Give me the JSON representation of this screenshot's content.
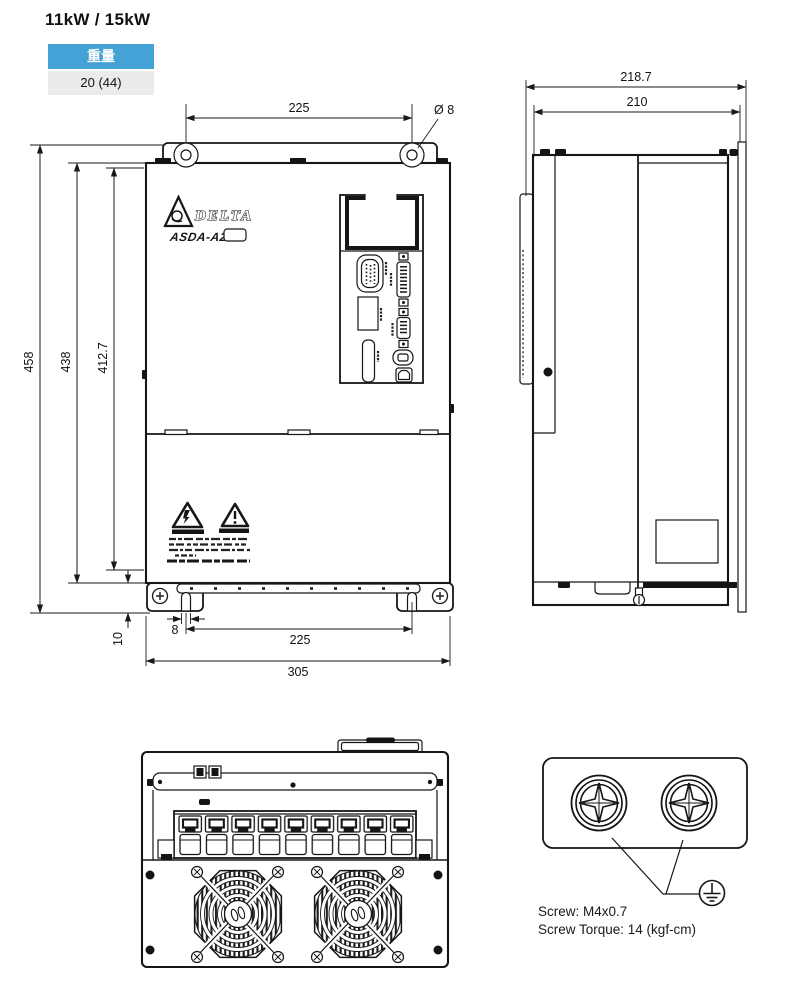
{
  "title": "11kW / 15kW",
  "weight_table": {
    "header": "重量",
    "value": "20 (44)"
  },
  "front_view": {
    "brand": "DELTA",
    "model": "ASDA-A2",
    "dims": {
      "top_hole_spacing": "225",
      "hole_diameter": "Ø 8",
      "overall_height": "458",
      "body_height": "438",
      "mounting_height": "412.7",
      "bottom_offset": "10",
      "slot_width": "8",
      "bottom_hole_spacing": "225",
      "overall_width": "305"
    }
  },
  "side_view": {
    "dims": {
      "overall_depth": "218.7",
      "body_depth": "210"
    }
  },
  "screw_detail": {
    "screw_note": "Screw: M4x0.7",
    "torque_note": "Screw Torque: 14 (kgf-cm)"
  },
  "colors": {
    "table_header_bg": "#45a2d6",
    "table_row_bg": "#ebebeb",
    "line_color": "#1a1a1a"
  }
}
